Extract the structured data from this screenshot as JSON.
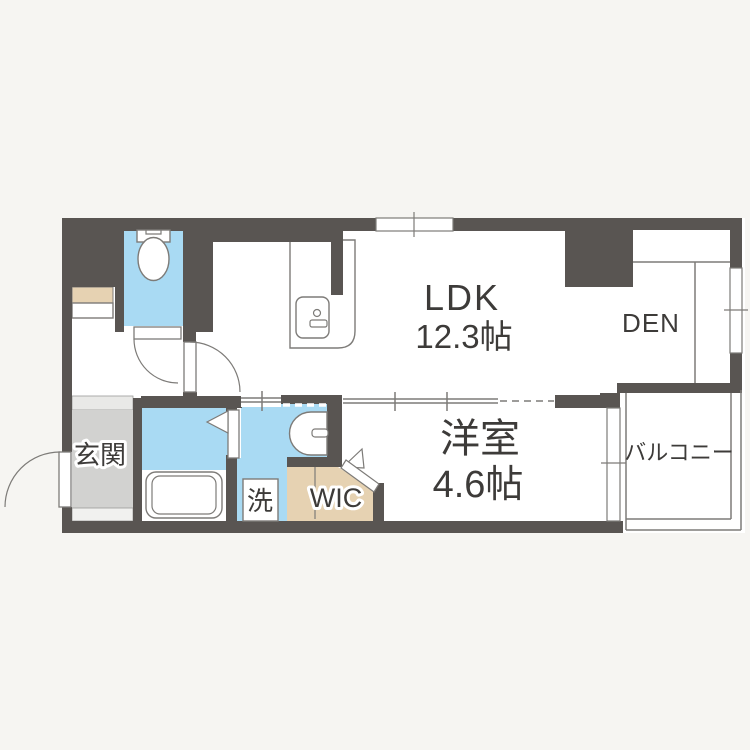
{
  "plan_type": "apartment-floor-plan",
  "colors": {
    "background": "#f6f5f2",
    "floor": "#ffffff",
    "wall": "#595552",
    "wet-area": "#a9daf3",
    "closet": "#e6d2b2",
    "entrance-floor": "#d2d2d0",
    "entrance-step": "#e9e9e7",
    "entrance-step2": "#f1f1ef",
    "line": "#7d7b78",
    "text": "#3d3b39"
  },
  "rooms": {
    "ldk": {
      "name": "LDK",
      "size": "12.3帖"
    },
    "den": {
      "name": "DEN"
    },
    "western_room": {
      "name": "洋室",
      "size": "4.6帖"
    },
    "balcony": {
      "name": "バルコニー"
    },
    "entrance": {
      "name": "玄関"
    },
    "walk_in_closet": {
      "name": "WIC"
    },
    "laundry": {
      "name": "洗"
    }
  },
  "fixtures": {
    "toilet": "toilet-icon",
    "bathtub": "bathtub-icon",
    "kitchen_sink": "kitchen-sink-icon",
    "wash_basin": "wash-basin-icon",
    "kitchen_counter": "kitchen-counter-icon"
  }
}
